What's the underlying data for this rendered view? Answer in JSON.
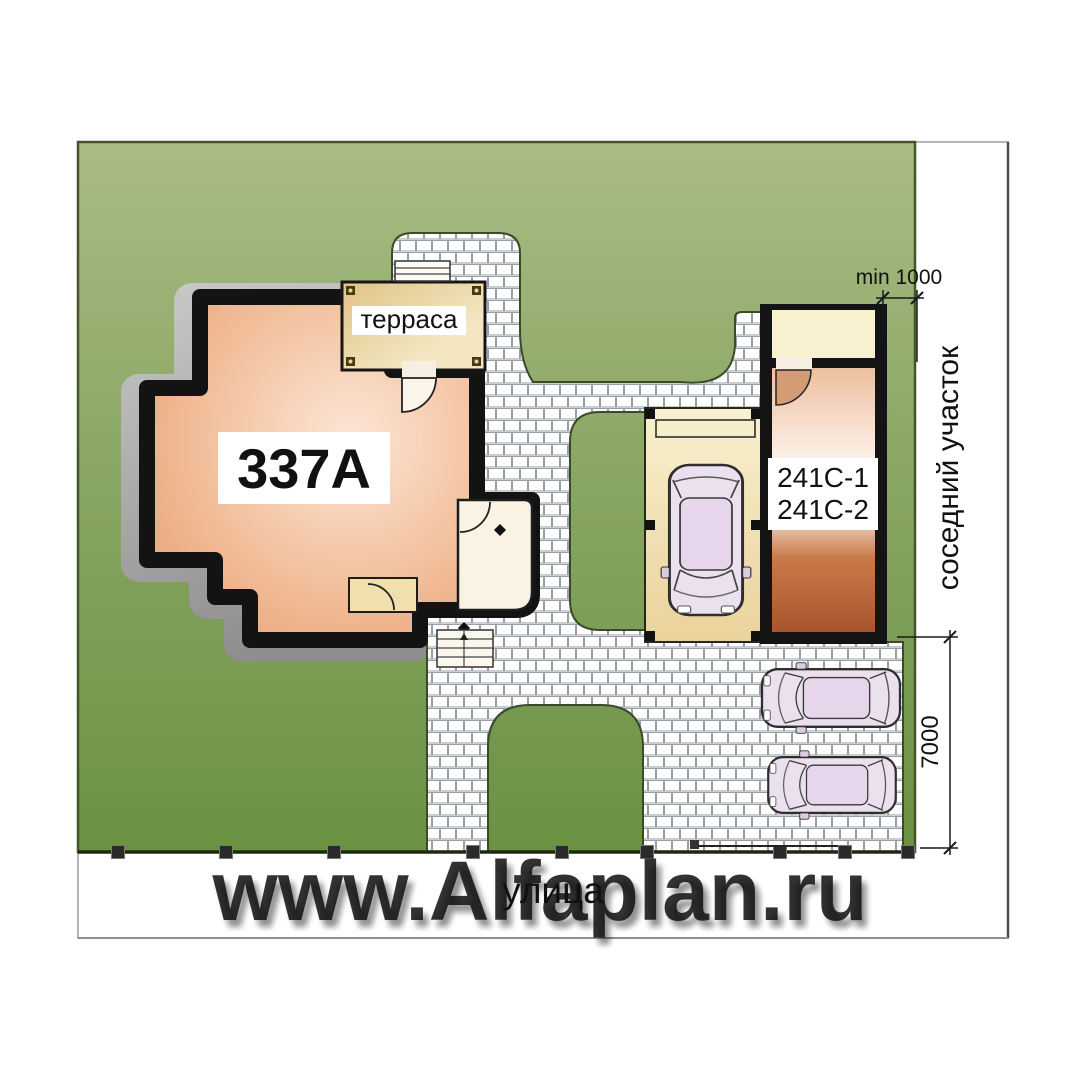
{
  "plan": {
    "house_label": "337A",
    "terrace_label": "терраса",
    "garage_label_1": "241C-1",
    "garage_label_2": "241C-2",
    "dim_side_offset": "min 1000",
    "dim_parking_depth": "7000",
    "neighbor_plot_label": "соседний участок",
    "street_label": "улица",
    "watermark": "www.Alfaplan.ru",
    "colors": {
      "lawn_light": "#a9bc84",
      "lawn_dark": "#6b9143",
      "house_fill": "#e9a077",
      "garage_fill": "#aa552e",
      "terrace_fill": "#e8d098",
      "carport_fill": "#f3e3b4",
      "wall": "#141414",
      "paving_joint": "#98a0a6",
      "shadow": "#a8a8a8"
    }
  }
}
